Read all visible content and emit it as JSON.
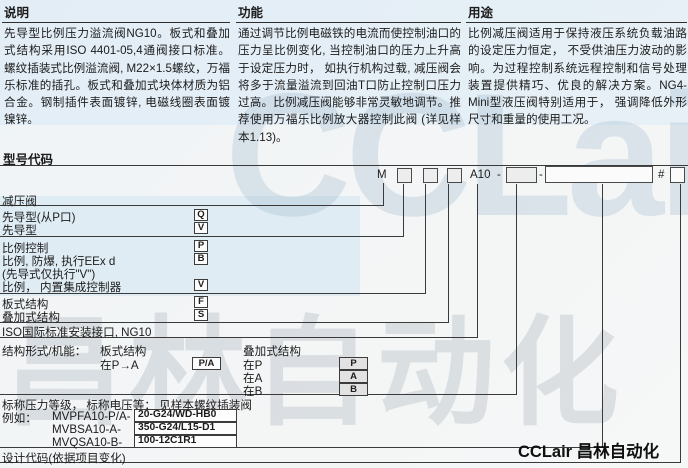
{
  "intro": {
    "desc": {
      "title": "说明",
      "body": "先导型比例压力溢流阀NG10。板式和叠加式结构采用ISO 4401-05,4通阀接口标准。螺纹插装式比例溢流阀, M22×1.5螺纹，万福乐标准的插孔。板式和叠加式块体材质为铝合金。钢制插件表面镀锌, 电磁线圈表面镀镍锌。"
    },
    "func": {
      "title": "功能",
      "body": "通过调节比例电磁铁的电流而使控制油口的压力呈比例变化, 当控制油口的压力上升高于设定压力时， 如执行机构过载, 减压阀会将多于流量溢流到回油T口防止控制口压力过高。比例减压阀能够非常灵敏地调节。推荐使用万福乐比例放大器控制此阀 (详见样本1.13)。"
    },
    "use": {
      "title": "用途",
      "body": "比例减压阀适用于保持液压系统负载油路的设定压力恒定， 不受供油压力波动的影响。为过程控制系统远程控制和信号处理装置提供精巧、优良的解决方案。NG4-Mini型液压阀特别适用于， 强调降低外形尺寸和重量的使用工况。"
    }
  },
  "model_code": {
    "title": "型号代码",
    "code": {
      "m": "M",
      "series": "A10",
      "dash1": "-",
      "dash2": "-",
      "hash": "#"
    },
    "rows": {
      "reducing_valve": "减压阀",
      "pilot_from_p": {
        "label": "先导型(从P口)",
        "code": "Q"
      },
      "pilot": {
        "label": "先导型",
        "code": "V"
      },
      "proportional": {
        "label": "比例控制",
        "code": "P"
      },
      "proportional_ex": {
        "label": "比例, 防爆, 执行EEx d",
        "code": "B"
      },
      "proportional_ex_note": "(先导式仅执行\"V\")",
      "proportional_integrated": {
        "label": "比例， 内置集成控制器",
        "code": "V"
      },
      "plate_type": {
        "label": "板式结构",
        "code": "F"
      },
      "stack_type": {
        "label": "叠加式结构",
        "code": "S"
      },
      "iso": "ISO国际标准安装接口, NG10"
    },
    "structure": {
      "label": "结构形式/机能：",
      "plate_header": "板式结构",
      "stack_header": "叠加式结构",
      "plate_row": {
        "label": "在P→A",
        "code": "P/A"
      },
      "stack_rows": [
        {
          "label": "在P",
          "code": "P"
        },
        {
          "label": "在A",
          "code": "A"
        },
        {
          "label": "在B",
          "code": "B"
        }
      ]
    },
    "pressure_note": "标称压力等级， 标称电压等： 见样本螺纹插装阀",
    "examples": {
      "label": "例如：",
      "items": [
        {
          "model": "MVPFA10-P/A-",
          "value": "20-G24/WD-HB0"
        },
        {
          "model": "MVBSA10-A-",
          "value": "350-G24/L15-D1"
        },
        {
          "model": "MVQSA10-B-",
          "value": "100-12C1R1"
        }
      ]
    },
    "design_code": "设计代码(依据项目变化)"
  },
  "branding": {
    "logo_text": "CCLair 昌林自动化",
    "watermark_latin": "CCLair",
    "watermark_cjk": "昌林自动化"
  },
  "colors": {
    "line": "#3a3a3a",
    "text": "#1c1c1c",
    "tint": "#cde2f4"
  }
}
